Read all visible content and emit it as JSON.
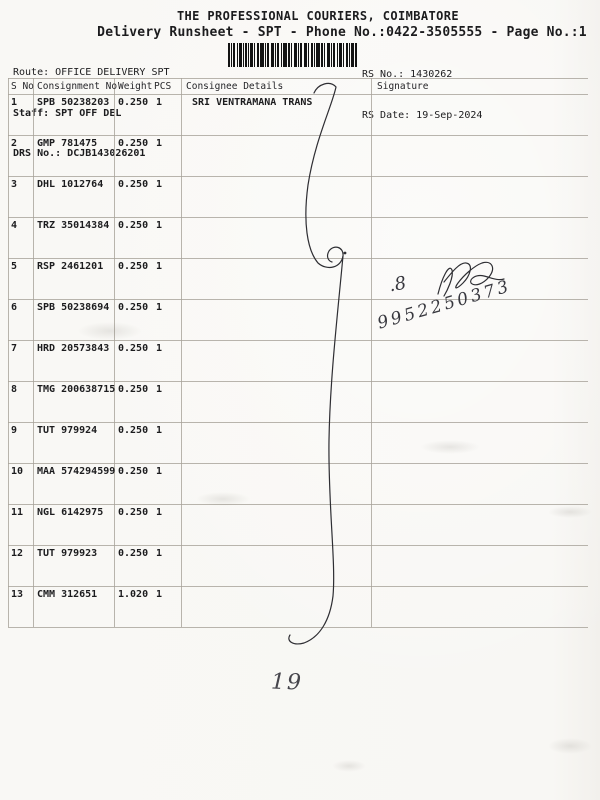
{
  "document": {
    "title": "THE PROFESSIONAL COURIERS, COIMBATORE",
    "subtitle": "Delivery Runsheet - SPT - Phone No.:0422-3505555 - Page No.:1",
    "route": "Route: OFFICE DELIVERY SPT",
    "staff": "Staff: SPT OFF DEL",
    "drs_no": "DRS No.: DCJB143026201",
    "rs_no": "RS No.: 1430262",
    "rs_date": "RS Date: 19-Sep-2024"
  },
  "table": {
    "headers": {
      "s_no": "S No",
      "consignment_no": "Consignment No",
      "weight": "Weight",
      "pcs": "PCS",
      "consignee": "Consignee Details",
      "signature": "Signature"
    },
    "rows": [
      {
        "s_no": "1",
        "consignment_no": "SPB 50238203",
        "weight": "0.250",
        "pcs": "1",
        "consignee": "SRI VENTRAMANA TRANS"
      },
      {
        "s_no": "2",
        "consignment_no": "GMP 781475",
        "weight": "0.250",
        "pcs": "1",
        "consignee": ""
      },
      {
        "s_no": "3",
        "consignment_no": "DHL 1012764",
        "weight": "0.250",
        "pcs": "1",
        "consignee": ""
      },
      {
        "s_no": "4",
        "consignment_no": "TRZ 35014384",
        "weight": "0.250",
        "pcs": "1",
        "consignee": ""
      },
      {
        "s_no": "5",
        "consignment_no": "RSP 2461201",
        "weight": "0.250",
        "pcs": "1",
        "consignee": ""
      },
      {
        "s_no": "6",
        "consignment_no": "SPB 50238694",
        "weight": "0.250",
        "pcs": "1",
        "consignee": ""
      },
      {
        "s_no": "7",
        "consignment_no": "HRD 20573843",
        "weight": "0.250",
        "pcs": "1",
        "consignee": ""
      },
      {
        "s_no": "8",
        "consignment_no": "TMG 200638715",
        "weight": "0.250",
        "pcs": "1",
        "consignee": ""
      },
      {
        "s_no": "9",
        "consignment_no": "TUT 979924",
        "weight": "0.250",
        "pcs": "1",
        "consignee": ""
      },
      {
        "s_no": "10",
        "consignment_no": "MAA 574294599",
        "weight": "0.250",
        "pcs": "1",
        "consignee": ""
      },
      {
        "s_no": "11",
        "consignment_no": "NGL 6142975",
        "weight": "0.250",
        "pcs": "1",
        "consignee": ""
      },
      {
        "s_no": "12",
        "consignment_no": "TUT 979923",
        "weight": "0.250",
        "pcs": "1",
        "consignee": ""
      },
      {
        "s_no": "13",
        "consignment_no": "CMM 312651",
        "weight": "1.020",
        "pcs": "1",
        "consignee": ""
      }
    ]
  },
  "handwriting": {
    "signature_note": ".8",
    "phone_number": "9952250373",
    "page_note": "19"
  },
  "colors": {
    "paper": "#f8f7f4",
    "ink": "#1c1c1e",
    "table_line": "#a8a29a",
    "pen_ink": "#38383f"
  }
}
